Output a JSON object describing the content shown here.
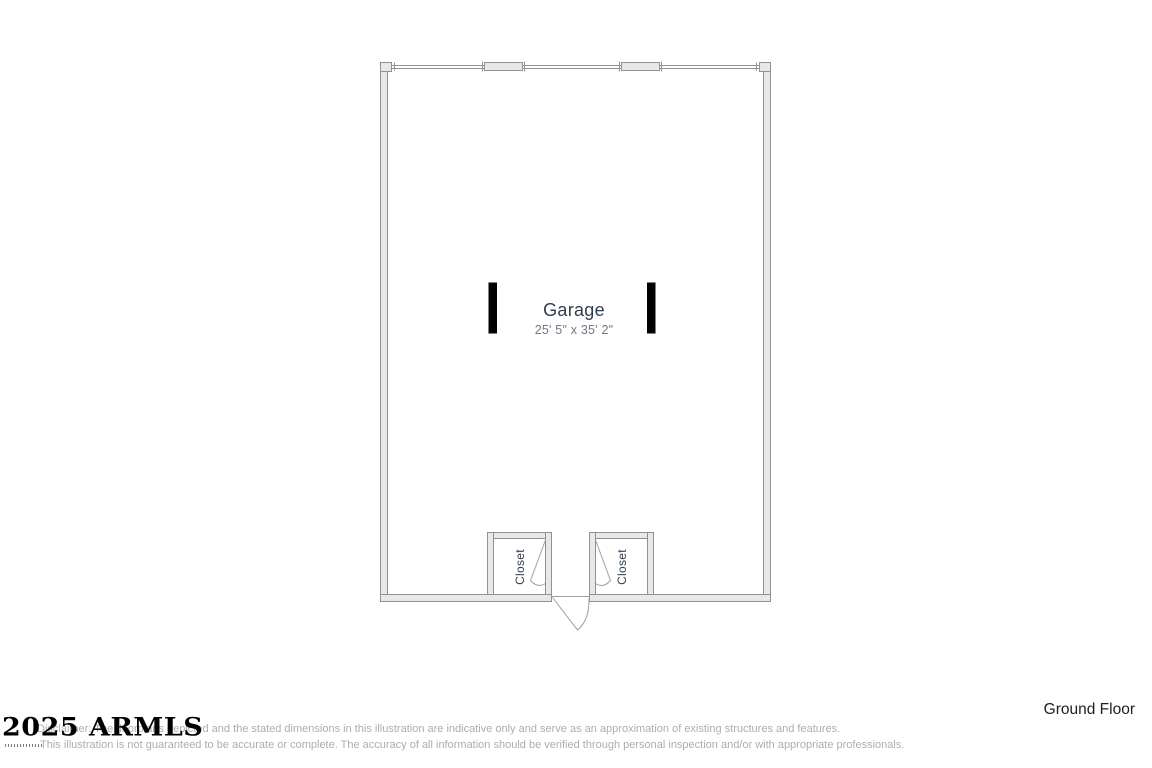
{
  "floor_plan": {
    "floor_label": "Ground Floor",
    "rooms": {
      "garage": {
        "label": "Garage",
        "dimensions": "25' 5\" x 35' 2\""
      },
      "closet_left": {
        "label": "Closet"
      },
      "closet_right": {
        "label": "Closet"
      }
    },
    "features": [
      "garage-door-opening-top-wall",
      "window-symbol-top-left",
      "window-symbol-top-right",
      "interior-column-post-left",
      "interior-column-post-right",
      "closet-door-swing-left",
      "closet-door-swing-right",
      "exterior-entry-door-swing-bottom-center"
    ]
  },
  "watermark": {
    "text": "2025 ARMLS"
  },
  "disclaimer": {
    "line1": "Disclaimer: The floorplans depicted and the stated dimensions in this illustration are indicative only and serve as an approximation of existing structures and features.",
    "line2": "This illustration is not guaranteed to be accurate or complete. The accuracy of all information should be verified through personal inspection and/or with appropriate professionals."
  },
  "colors": {
    "wall_fill": "#e8e8e8",
    "wall_stroke": "#8f9193",
    "door_swing_stroke": "#9aa0a4",
    "post_fill": "#000000",
    "room_label_text": "#2e3d50",
    "dimension_text": "#6b7888",
    "disclaimer_text": "#a9aeb4",
    "floor_label_text": "#1f1f21",
    "watermark_text": "#000000"
  }
}
